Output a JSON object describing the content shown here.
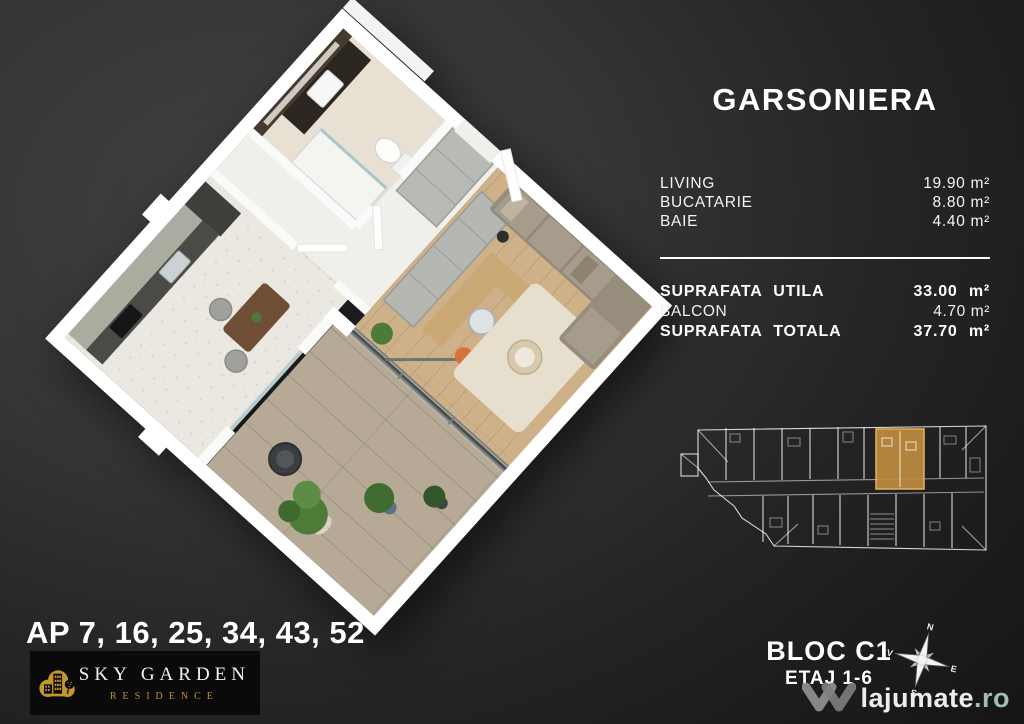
{
  "info": {
    "title": "GARSONIERA",
    "areas": [
      {
        "label": "LIVING",
        "value": "19.90 m²"
      },
      {
        "label": "BUCATARIE",
        "value": "8.80 m²"
      },
      {
        "label": "BAIE",
        "value": "4.40 m²"
      }
    ],
    "totals": [
      {
        "label": "SUPRAFATA UTILA",
        "value": "33.00 m²"
      },
      {
        "label": "BALCON",
        "value": "4.70 m²"
      },
      {
        "label": "SUPRAFATA TOTALA",
        "value": "37.70 m²"
      }
    ]
  },
  "footer": {
    "apartments": "AP 7, 16, 25, 34, 43, 52",
    "block_name": "BLOC C1",
    "block_floors": "ETAJ 1-6"
  },
  "compass": {
    "north": "N",
    "east": "E",
    "south": "S",
    "west": "V"
  },
  "brand": {
    "name": "SKY GARDEN",
    "subtitle": "RESIDENCE",
    "gold": "#c2952e"
  },
  "watermark": {
    "site": "lajumate",
    "tld": ".ro",
    "tld_color": "#9fbcb8"
  },
  "building": {
    "highlight_color": "#bf8c3f"
  },
  "plan_rooms": [
    "bucatarie",
    "baie",
    "hol",
    "living",
    "balcon"
  ]
}
